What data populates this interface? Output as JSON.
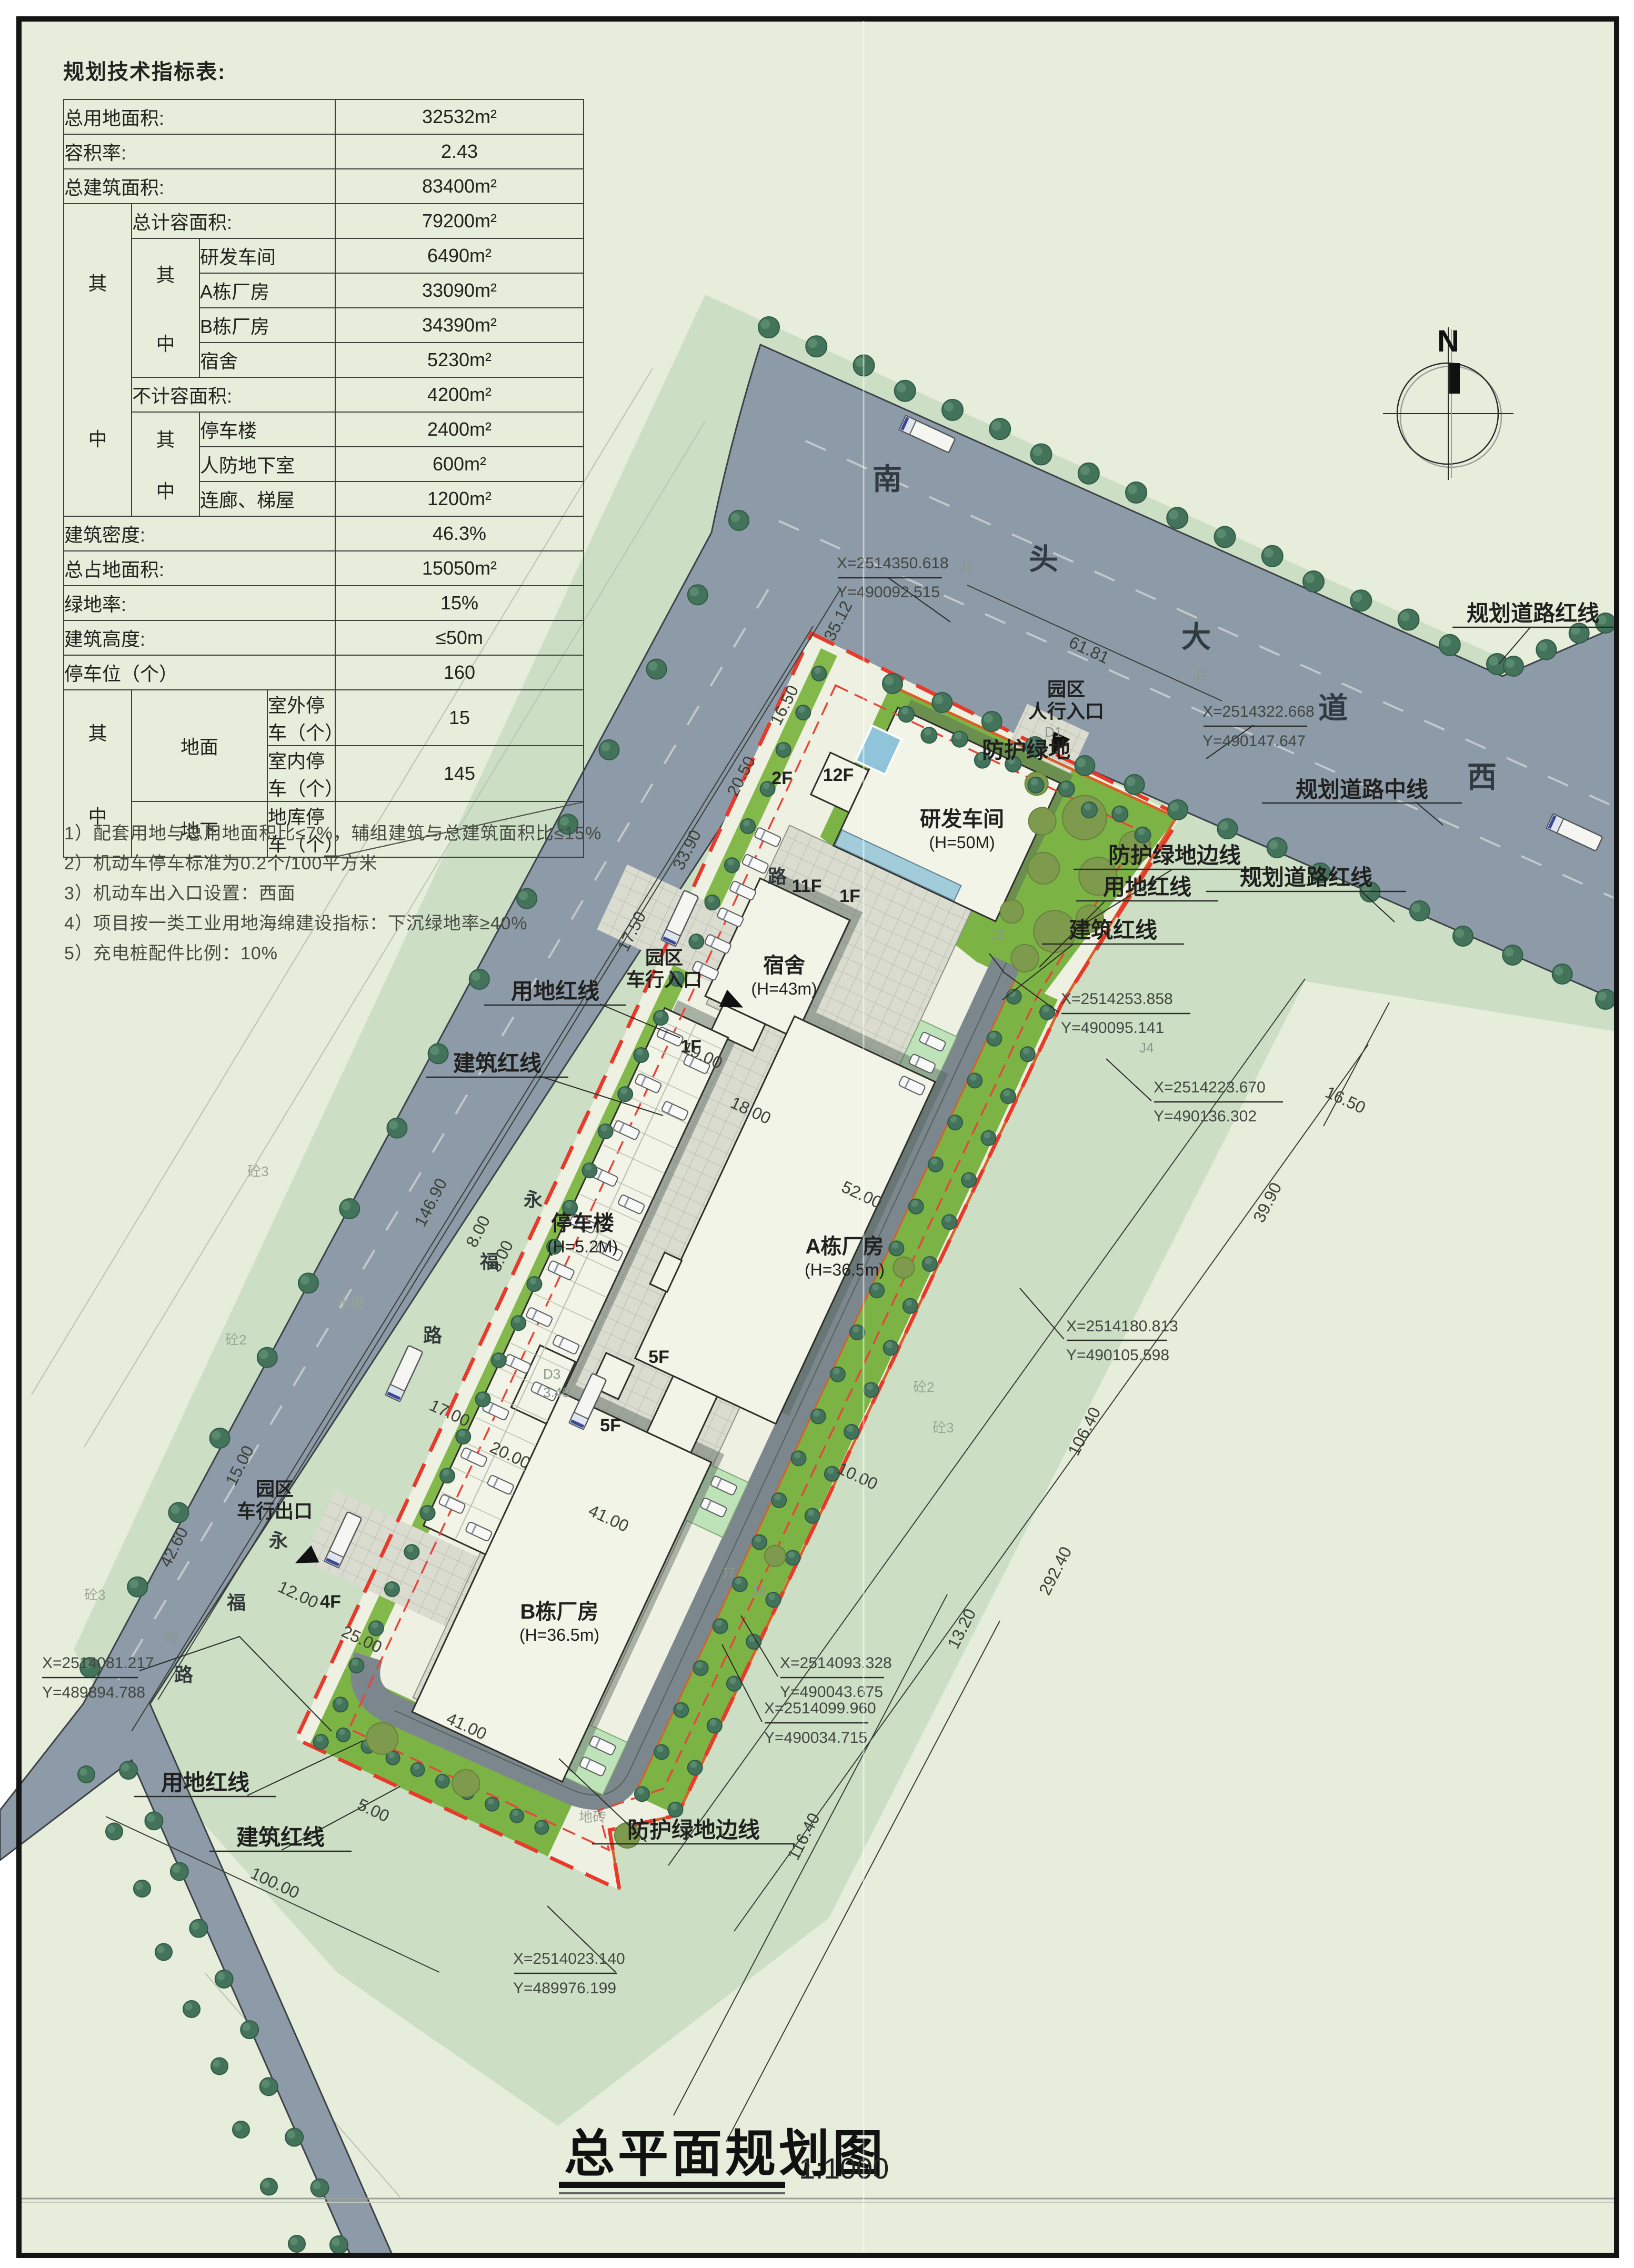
{
  "page": {
    "title": "总平面规划图",
    "scale_label": "1:1000"
  },
  "table": {
    "title": "规划技术指标表:",
    "qi": "其",
    "zhong": "中",
    "span_dimian": "地面",
    "span_dixia": "地下",
    "r": [
      {
        "l": "总用地面积:",
        "v": "32532m²"
      },
      {
        "l": "容积率:",
        "v": "2.43"
      },
      {
        "l": "总建筑面积:",
        "v": "83400m²"
      },
      {
        "l": "总计容面积:",
        "v": "79200m²"
      },
      {
        "l": "研发车间",
        "v": "6490m²"
      },
      {
        "l": "A栋厂房",
        "v": "33090m²"
      },
      {
        "l": "B栋厂房",
        "v": "34390m²"
      },
      {
        "l": "宿舍",
        "v": "5230m²"
      },
      {
        "l": "不计容面积:",
        "v": "4200m²"
      },
      {
        "l": "停车楼",
        "v": "2400m²"
      },
      {
        "l": "人防地下室",
        "v": "600m²"
      },
      {
        "l": "连廊、梯屋",
        "v": "1200m²"
      },
      {
        "l": "建筑密度:",
        "v": "46.3%"
      },
      {
        "l": "总占地面积:",
        "v": "15050m²"
      },
      {
        "l": "绿地率:",
        "v": "15%"
      },
      {
        "l": "建筑高度:",
        "v": "≤50m"
      },
      {
        "l": "停车位（个）",
        "v": "160"
      },
      {
        "l": "室外停车（个）",
        "v": "15"
      },
      {
        "l": "室内停车（个）",
        "v": "145"
      },
      {
        "l": "地库停车（个）",
        "v": ""
      }
    ],
    "notes": [
      "1）配套用地与总用地面积比≤7%，辅组建筑与总建筑面积比≤15%",
      "2）机动车停车标准为0.2个/100平方米",
      "3）机动车出入口设置：西面",
      "4）项目按一类工业用地海绵建设指标：下沉绿地率≥40%",
      "5）充电桩配件比例：10%"
    ]
  },
  "map": {
    "north": "N",
    "road_chars": [
      "南",
      "头",
      "大",
      "道",
      "西"
    ],
    "street_chars": [
      "永",
      "福",
      "路",
      "永",
      "福",
      "路",
      "路"
    ],
    "labels": {
      "fanghu": "防护绿地",
      "fanghu_edge_r": "防护绿地边线",
      "fanghu_edge_b": "防护绿地边线",
      "yongdi_lt": "用地红线",
      "jianzhu_lt": "建筑红线",
      "yongdi_r": "用地红线",
      "jianzhu_r": "建筑红线",
      "yongdi_b": "用地红线",
      "jianzhu_b": "建筑红线",
      "daolu_hong_t": "规划道路红线",
      "daolu_zhong": "规划道路中线",
      "daolu_hong_b": "规划道路红线",
      "ped1": "园区",
      "ped2": "人行入口",
      "cin1": "园区",
      "cin2": "车行入口",
      "cout1": "园区",
      "cout2": "车行出口"
    },
    "buildings": {
      "yanfa1": "研发车间",
      "yanfa2": "(H=50M)",
      "sushe1": "宿舍",
      "sushe2": "(H=43m)",
      "tingche1": "停车楼",
      "tingche2": "(H=5.2M)",
      "adong1": "A栋厂房",
      "adong2": "(H=36.5m)",
      "bdong1": "B栋厂房",
      "bdong2": "(H=36.5m)"
    },
    "floors": {
      "f2": "2F",
      "f12": "12F",
      "f11": "11F",
      "f1a": "1F",
      "f1b": "1F",
      "f5a": "5F",
      "f5b": "5F",
      "f4": "4F"
    },
    "dims": [
      "61.81",
      "35.12",
      "16.50",
      "20.50",
      "33.90",
      "17.50",
      "146.90",
      "8.00",
      "3.00",
      "17.00",
      "20.00",
      "15.00",
      "42.60",
      "12.00",
      "25.00",
      "41.00",
      "41.00",
      "5.00",
      "100.00",
      "19.00",
      "18.00",
      "10.00",
      "52.00",
      "16.50",
      "39.90",
      "106.40",
      "292.40",
      "13.20",
      "116.40"
    ],
    "coords": [
      {
        "x": "X=2514350.618",
        "y": "Y=490092.515"
      },
      {
        "x": "X=2514322.668",
        "y": "Y=490147.647"
      },
      {
        "x": "X=2514253.858",
        "y": "Y=490095.141"
      },
      {
        "x": "X=2514223.670",
        "y": "Y=490136.302"
      },
      {
        "x": "X=2514180.813",
        "y": "Y=490105.598"
      },
      {
        "x": "X=2514093.328",
        "y": "Y=490043.675"
      },
      {
        "x": "X=2514099.960",
        "y": "Y=490034.715"
      },
      {
        "x": "X=2514081.217",
        "y": "Y=489894.788"
      },
      {
        "x": "X=2514023.140",
        "y": "Y=489976.199"
      }
    ],
    "markers": [
      "J1",
      "J2",
      "J3",
      "J4",
      "J6",
      "J7",
      "J9",
      "D1",
      "D3",
      "3.40"
    ],
    "faint": [
      "砼3",
      "砼2",
      "水泥",
      "砼3",
      "砼2",
      "砼3",
      "地砖"
    ]
  },
  "colors": {
    "page_bg": "#e6edda",
    "band": "#ccdfc5",
    "road": "#8d9aa7",
    "green": "#7cb345",
    "verge": "#83b84b",
    "building": "#f1f4e6",
    "plaza": "#dbdcd0",
    "red_line": "#e8392b",
    "orange_line": "#d95f28",
    "pool_blue": "#8fc4da",
    "tree": "#44735c"
  }
}
